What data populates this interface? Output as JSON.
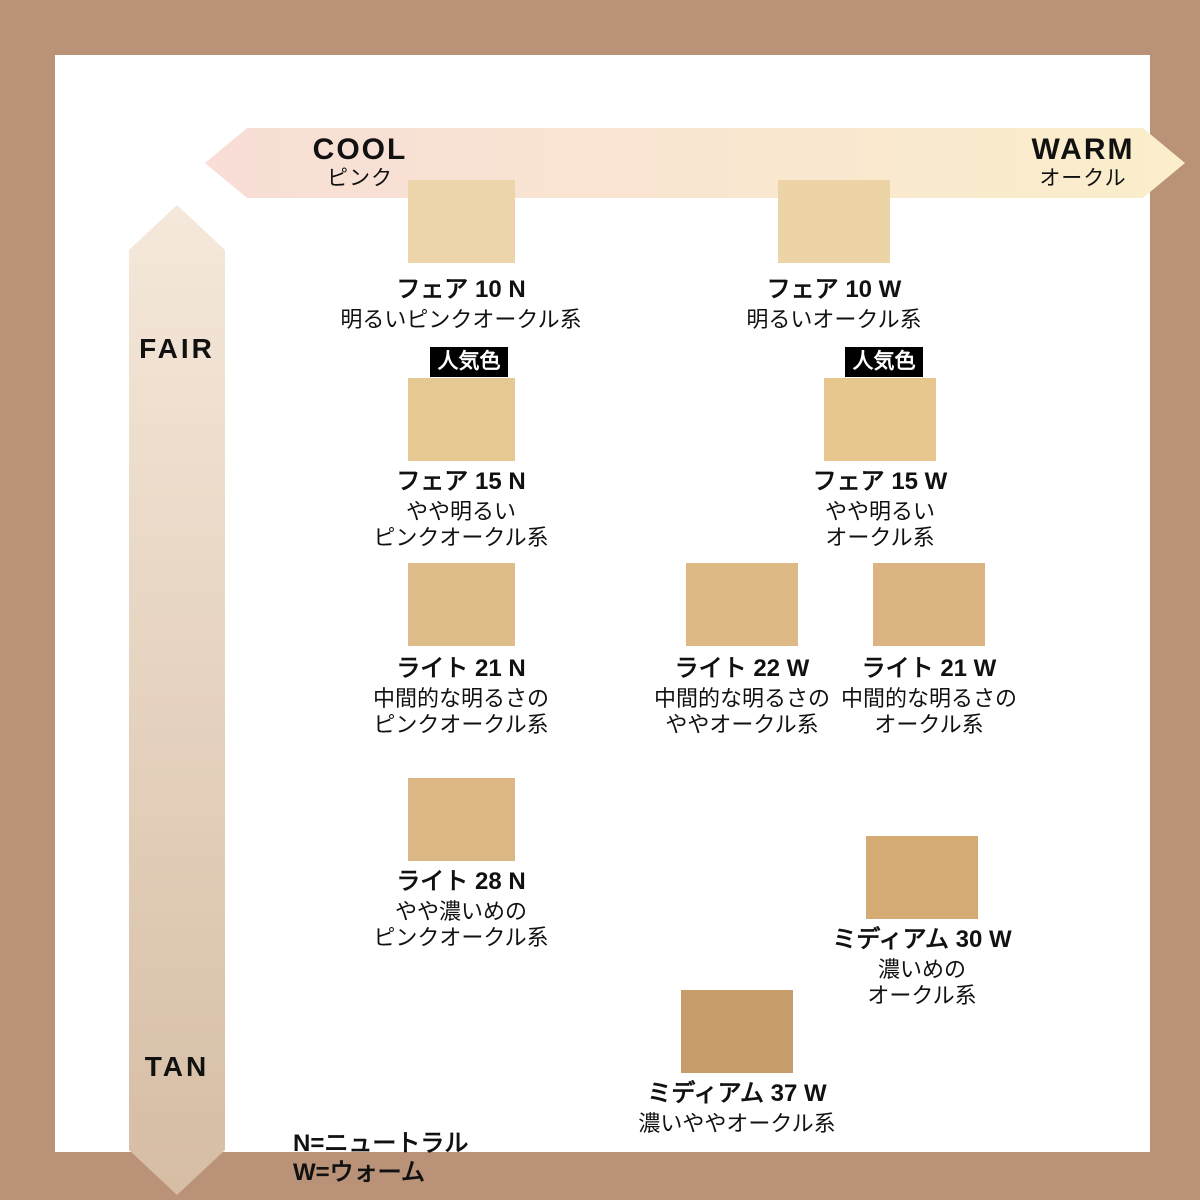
{
  "axes": {
    "horizontal": {
      "left_label": "COOL",
      "left_sublabel": "ピンク",
      "right_label": "WARM",
      "right_sublabel": "オークル",
      "gradient_left": "#f8ded6",
      "gradient_right": "#faeecb"
    },
    "vertical": {
      "top_label": "FAIR",
      "bottom_label": "TAN",
      "gradient_top": "#f5e8da",
      "gradient_bottom": "#d6bda4"
    }
  },
  "popular_badge_label": "人気色",
  "shades": [
    {
      "id": "fair-10n",
      "name": "フェア 10 N",
      "description_lines": [
        "明るいピンクオークル系"
      ],
      "color": "#ecd5ab",
      "popular": false
    },
    {
      "id": "fair-10w",
      "name": "フェア 10 W",
      "description_lines": [
        "明るいオークル系"
      ],
      "color": "#edd4a6",
      "popular": false
    },
    {
      "id": "fair-15n",
      "name": "フェア 15 N",
      "description_lines": [
        "やや明るい",
        "ピンクオークル系"
      ],
      "color": "#e6c893",
      "popular": true
    },
    {
      "id": "fair-15w",
      "name": "フェア 15 W",
      "description_lines": [
        "やや明るい",
        "オークル系"
      ],
      "color": "#e7c78e",
      "popular": true
    },
    {
      "id": "light-21n",
      "name": "ライト 21 N",
      "description_lines": [
        "中間的な明るさの",
        "ピンクオークル系"
      ],
      "color": "#dfbd8a",
      "popular": false
    },
    {
      "id": "light-22w",
      "name": "ライト 22 W",
      "description_lines": [
        "中間的な明るさの",
        "ややオークル系"
      ],
      "color": "#dcb985",
      "popular": false
    },
    {
      "id": "light-21w",
      "name": "ライト 21 W",
      "description_lines": [
        "中間的な明るさの",
        "オークル系"
      ],
      "color": "#dcb483",
      "popular": false
    },
    {
      "id": "light-28n",
      "name": "ライト 28 N",
      "description_lines": [
        "やや濃いめの",
        "ピンクオークル系"
      ],
      "color": "#dcb685",
      "popular": false
    },
    {
      "id": "medium-30w",
      "name": "ミディアム 30 W",
      "description_lines": [
        "濃いめの",
        "オークル系"
      ],
      "color": "#d4ab72",
      "popular": false
    },
    {
      "id": "medium-37w",
      "name": "ミディアム 37 W",
      "description_lines": [
        "濃いややオークル系"
      ],
      "color": "#c69d6b",
      "popular": false
    }
  ],
  "legend": {
    "lines": [
      "N=ニュートラル",
      "W=ウォーム"
    ]
  },
  "colors": {
    "frame": "#ba9277",
    "panel": "#ffffff",
    "badge_bg": "#000000",
    "badge_text": "#ffffff",
    "text": "#111111"
  }
}
